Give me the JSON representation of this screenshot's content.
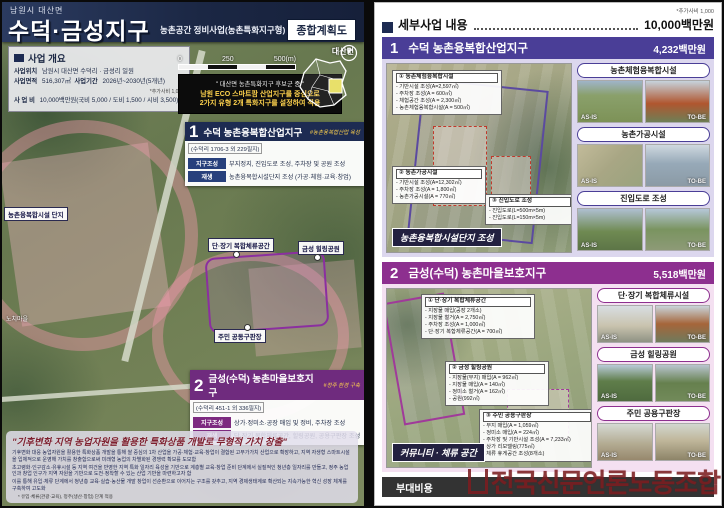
{
  "watermark": "전국신문언론노동조합",
  "left_page": {
    "header": {
      "region": "남원시 대산면",
      "title": "수덕·금성지구",
      "subtitle": "농촌공간 정비사업(농촌특화지구형)",
      "badge": "종합계획도"
    },
    "overview": {
      "title": "사업 개요",
      "loc_label": "사업위치",
      "loc_value": "남원시 대산면 수덕리 · 금성리 일원",
      "area_label": "사업면적",
      "area_value": "516,307㎡",
      "period_label": "사업기간",
      "period_value": "2026년~2030년(5개년)",
      "unit_note": "*추가사비 1,000",
      "cost_label": "사 업 비",
      "cost_value": "10,000백만원(국비 5,000 / 도비 1,500 / 시비 3,500)"
    },
    "scalebar": {
      "t0": "0",
      "t1": "250",
      "t2": "500(m)"
    },
    "quote": {
      "line1": "\" 대산면 농촌특화지구 후보군 중 \"",
      "line2": "남원 ECO 스마트팜 산업지구를 중심으로",
      "line3": "2가지 유형 2개 특화지구를 설정하여 적용"
    },
    "inset": {
      "label": "대산면"
    },
    "section1": {
      "no": "1",
      "title": "수덕 농촌융복합산업지구",
      "tag": "#농촌융복합산업 육성",
      "address": "(수덕리 1706-3 외 229필지)",
      "row1_label": "지구조성",
      "row1_value": "부지정지, 진입도로 조성, 주차장 및 공원 조성",
      "row2_label": "재생",
      "row2_value": "농촌융복합시설단지 조성 (가공·체험·교육·창업)"
    },
    "section2": {
      "no": "2",
      "title": "금성(수덕) 농촌마을보호지구",
      "tag": "#정주 환경 구축",
      "address": "(수덕리 451-1 외 336필지)",
      "row1_label": "지구조성",
      "row1_value": "상가·정미소·공장 매입 및 정비, 주차장 조성",
      "row2_label": "재생",
      "row2_value": "단·장기 복합체류공간, 힐링공원, 공용구판장 조성"
    },
    "map_labels": {
      "complex": "농촌융복합시설 단지",
      "stay": "단·장기 복합체류공간",
      "park": "금성 힐링공원",
      "market": "주민 공동구판장",
      "village": "노치마을"
    },
    "goal": {
      "title": "\"기후변화 지역 농업자원을 활용한 특화상품 개발로 무형적 가치 창출\"",
      "b1": "기후변화 대응 농업자원을 활용한 특화상품 개발을 통해 쌀 중심의 1차 산업을 가공·체험·교육·창업이 결합된 고부가가치 산업으로 확장하고, 지역 자생형 스마트시설을 입체적으로 운영해 가치를 창출함으로써 미래형 농업의 차별화된 경쟁력 확보를 도모함",
      "b2": "초고령화·인구감소·유휴시설 등 지역 여건을 반영한 지역 특화 일자리 육성을 기반으로 계층별 교육·창업 준비 단계에서 실질적인 청년층 일자리를 만들고, 정주 농업인과 창업 인구가 지역 자원을 기반으로 도전·정착할 수 있는 산업 기반을 마련하고자 함",
      "b3": "이를 통해 유입·체류 단계에서 청년층 교육·실습·농산물 개발 창업이 선순환으로 이어지는 구조를 갖추고, 지역 경제생태계로 확산되는 지속가능한 혁신 성장 체계를 구축하여 고도화",
      "note": "* 유입·체류(관광·교육), 정주(생산·창업) 단계 적용"
    }
  },
  "right_page": {
    "unit_note": "*추가사비 1,000",
    "header": {
      "title": "세부사업 내용",
      "total": "10,000백만원"
    },
    "section1": {
      "no": "1",
      "title": "수덕 농촌융복합산업지구",
      "amount": "4,232백만원",
      "badge": "농촌융복합시설단지 조성",
      "callout1": {
        "title": "① 농촌체험융복합시설",
        "l1": "- 기반시설 조성(A=2,597㎡)",
        "l2": "- 주차장 조성(A = 600㎡)",
        "l3": "- 체험공간 조성(A = 2,300㎡)",
        "l4": "- 농촌체험융복합시설(A = 500㎡)"
      },
      "callout2": {
        "title": "② 농촌가공시설",
        "l1": "- 기반시설 조성(A=12,302㎡)",
        "l2": "- 주차장 조성(A = 1,800㎡)",
        "l3": "- 농촌가공시설(A = 770㎡)"
      },
      "callout3": {
        "title": "③ 진입도로 조성",
        "l1": "- 진입도로(L=500m×5m)",
        "l2": "- 진입도로(L=150m×5m)"
      },
      "items": [
        {
          "label": "농촌체험융복합시설",
          "before": "AS-IS",
          "after": "TO-BE"
        },
        {
          "label": "농촌가공시설",
          "before": "AS-IS",
          "after": "TO-BE"
        },
        {
          "label": "진입도로 조성",
          "before": "AS-IS",
          "after": "TO-BE"
        }
      ]
    },
    "section2": {
      "no": "2",
      "title": "금성(수덕) 농촌마을보호지구",
      "amount": "5,518백만원",
      "badge": "커뮤니티 · 체류 공간",
      "callout1": {
        "title": "① 단·장기 복합체류공간",
        "l1": "- 지장물 매입(공장 2개소)",
        "l2": "- 지장물 철거(A = 2,750㎡)",
        "l3": "- 주차장 조성(A = 1,000㎡)",
        "l4": "- 단·장기 복합체류공간(A = 700㎡)"
      },
      "callout2": {
        "title": "② 금성 힐링공원",
        "l1": "- 지장물(부지) 매입(A = 962㎡)",
        "l2": "- 지장물 매입(A = 140㎡)",
        "l3": "- 정미소 철거(A = 162㎡)",
        "l4": "- 공원(992㎡)"
      },
      "callout3": {
        "title": "③ 주민 공용구판장",
        "l1": "- 부지 매입(A = 1,059㎡)",
        "l2": "- 정미소 매입(A = 224㎡)",
        "l3": "- 주차장 및 기반시설 조성(A = 7,233㎡)",
        "l4": "- 상가 리모델링(775㎡)",
        "l5": "- 체류 휴게공간 조성(8개소)"
      },
      "items": [
        {
          "label": "단·장기 복합체류시설",
          "before": "AS-IS",
          "after": "TO-BE"
        },
        {
          "label": "금성 힐링공원",
          "before": "AS-IS",
          "after": "TO-BE"
        },
        {
          "label": "주민 공용구판장",
          "before": "AS-IS",
          "after": "TO-BE"
        }
      ]
    },
    "footer": {
      "label": "부대비용"
    }
  }
}
